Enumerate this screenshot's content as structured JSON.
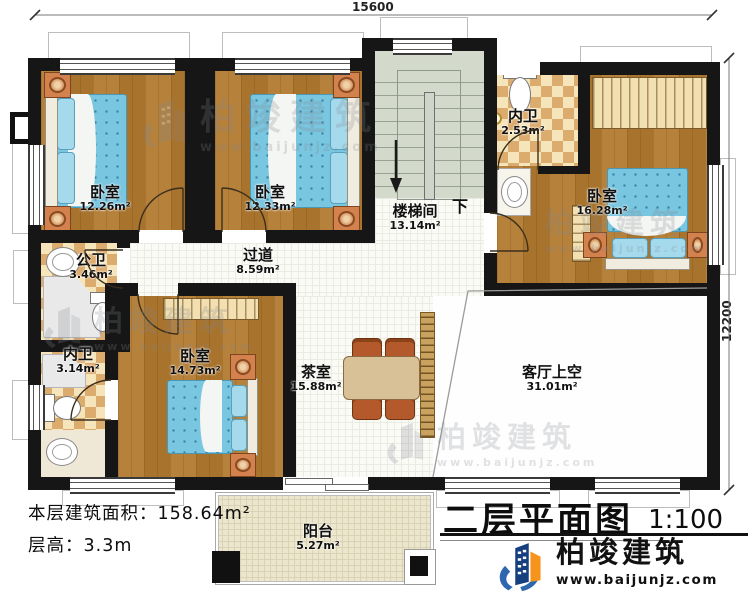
{
  "dimensions": {
    "top": "15600",
    "right": "12200"
  },
  "rooms": [
    {
      "name": "卧室",
      "area": "12.26m²"
    },
    {
      "name": "卧室",
      "area": "12.33m²"
    },
    {
      "name": "楼梯间",
      "area": "13.14m²"
    },
    {
      "name": "内卫",
      "area": "2.53m²"
    },
    {
      "name": "卧室",
      "area": "16.28m²"
    },
    {
      "name": "公卫",
      "area": "3.46m²"
    },
    {
      "name": "过道",
      "area": "8.59m²"
    },
    {
      "name": "内卫",
      "area": "3.14m²"
    },
    {
      "name": "卧室",
      "area": "14.73m²"
    },
    {
      "name": "茶室",
      "area": "15.88m²"
    },
    {
      "name": "客厅上空",
      "area": "31.01m²"
    },
    {
      "name": "阳台",
      "area": "5.27m²"
    }
  ],
  "stairs": {
    "down_label": "下"
  },
  "notes": {
    "area_label": "本层建筑面积：",
    "area_value": "158.64m²",
    "height_label": "层高：",
    "height_value": "3.3m"
  },
  "title": {
    "text": "二层平面图",
    "scale": "1:100"
  },
  "brand": {
    "name": "柏竣建筑",
    "url": "www.baijunjz.com"
  },
  "watermark": {
    "name": "柏竣建筑",
    "url": "www.baijunjz.com"
  },
  "colors": {
    "wall": "#161616",
    "wood_floor": "#b1792f",
    "bath_checker": "#dcab6e",
    "stair": "#d3dacc",
    "bed_blue": "#79c6e0",
    "logo_blue": "#1b4f9c",
    "logo_orange": "#f7941d"
  }
}
